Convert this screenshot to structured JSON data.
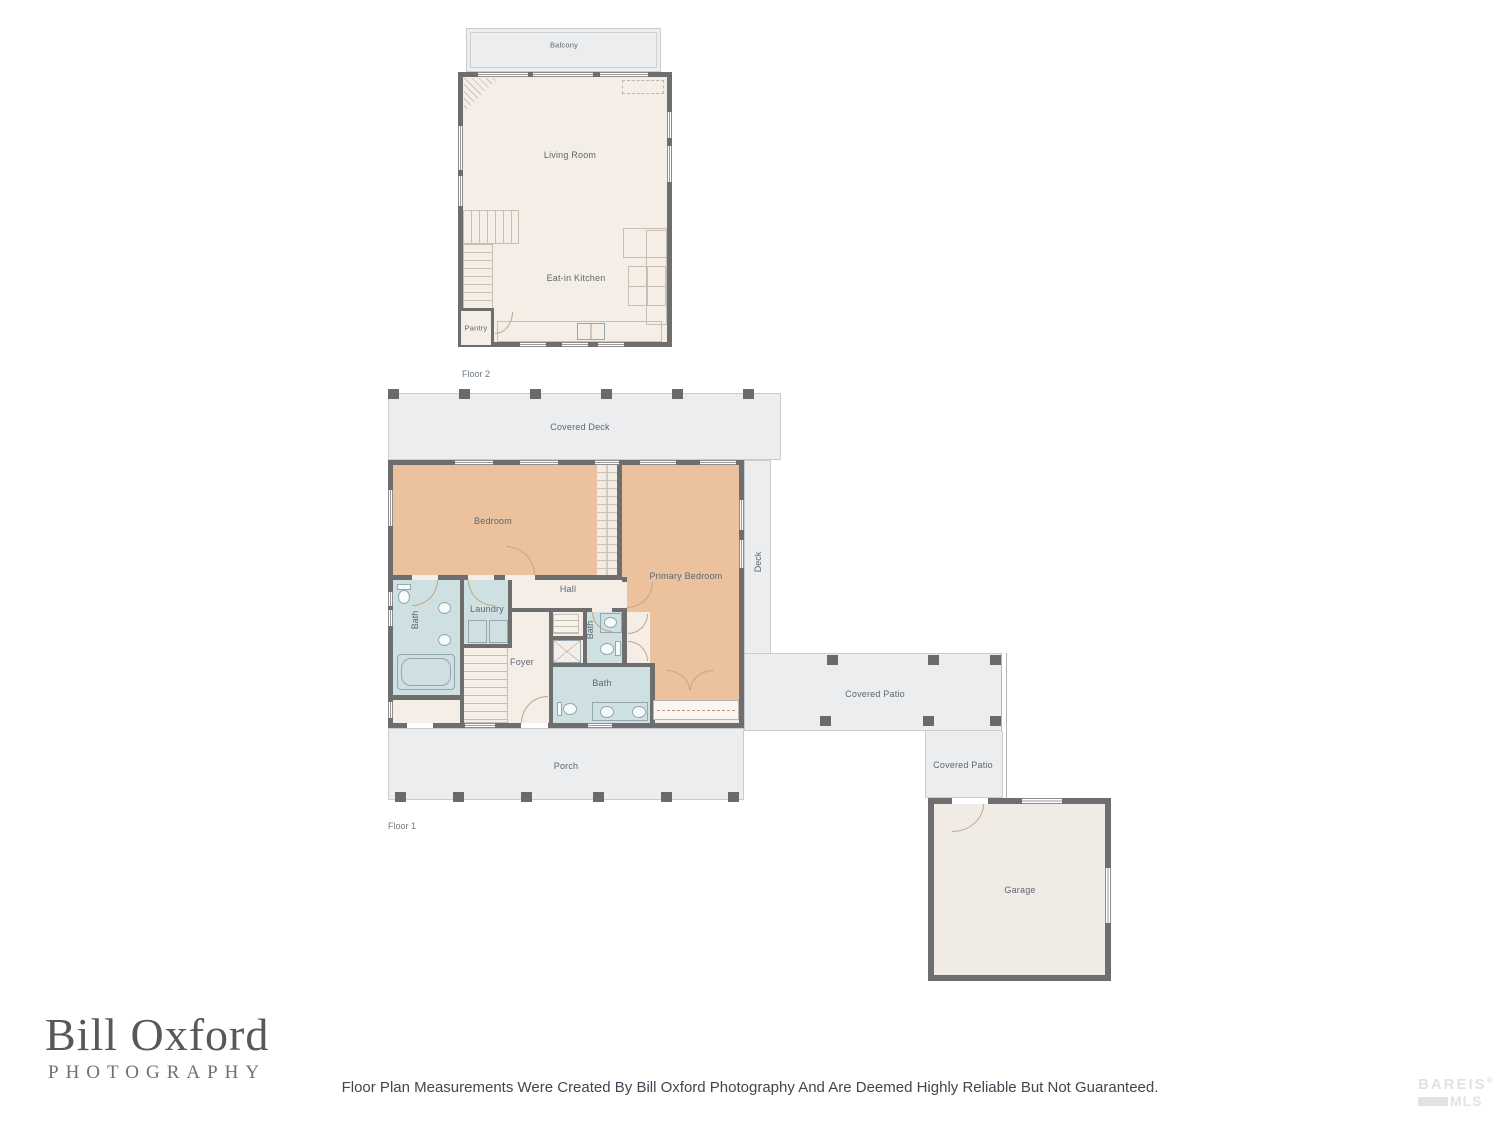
{
  "floor2": {
    "floor_label": "Floor 2",
    "rooms": {
      "balcony": "Balcony",
      "living_room": "Living Room",
      "eat_in_kitchen": "Eat-in Kitchen",
      "pantry": "Pantry"
    }
  },
  "floor1": {
    "floor_label": "Floor 1",
    "rooms": {
      "covered_deck": "Covered Deck",
      "bedroom": "Bedroom",
      "primary_bedroom": "Primary Bedroom",
      "deck": "Deck",
      "hall": "Hall",
      "bath_left": "Bath",
      "laundry": "Laundry",
      "foyer": "Foyer",
      "bath_small": "Bath",
      "bath_main": "Bath",
      "porch": "Porch",
      "covered_patio_upper": "Covered Patio",
      "covered_patio_lower": "Covered Patio",
      "garage": "Garage"
    }
  },
  "branding": {
    "photographer_name": "Bill Oxford",
    "photographer_subtitle": "PHOTOGRAPHY",
    "disclaimer": "Floor Plan Measurements Were Created By Bill Oxford Photography And Are Deemed Highly Reliable But Not Guaranteed.",
    "mls_line1": "BAREIS",
    "mls_line2": "MLS",
    "mls_reg": "®"
  },
  "colors": {
    "wall": "#6e6e6e",
    "interior_beige": "#f5eee7",
    "bedroom_tan": "#ebc29d",
    "bathroom_blue": "#cfe0e2",
    "outdoor_gray": "#ebedee",
    "label_text": "#5c6670"
  }
}
